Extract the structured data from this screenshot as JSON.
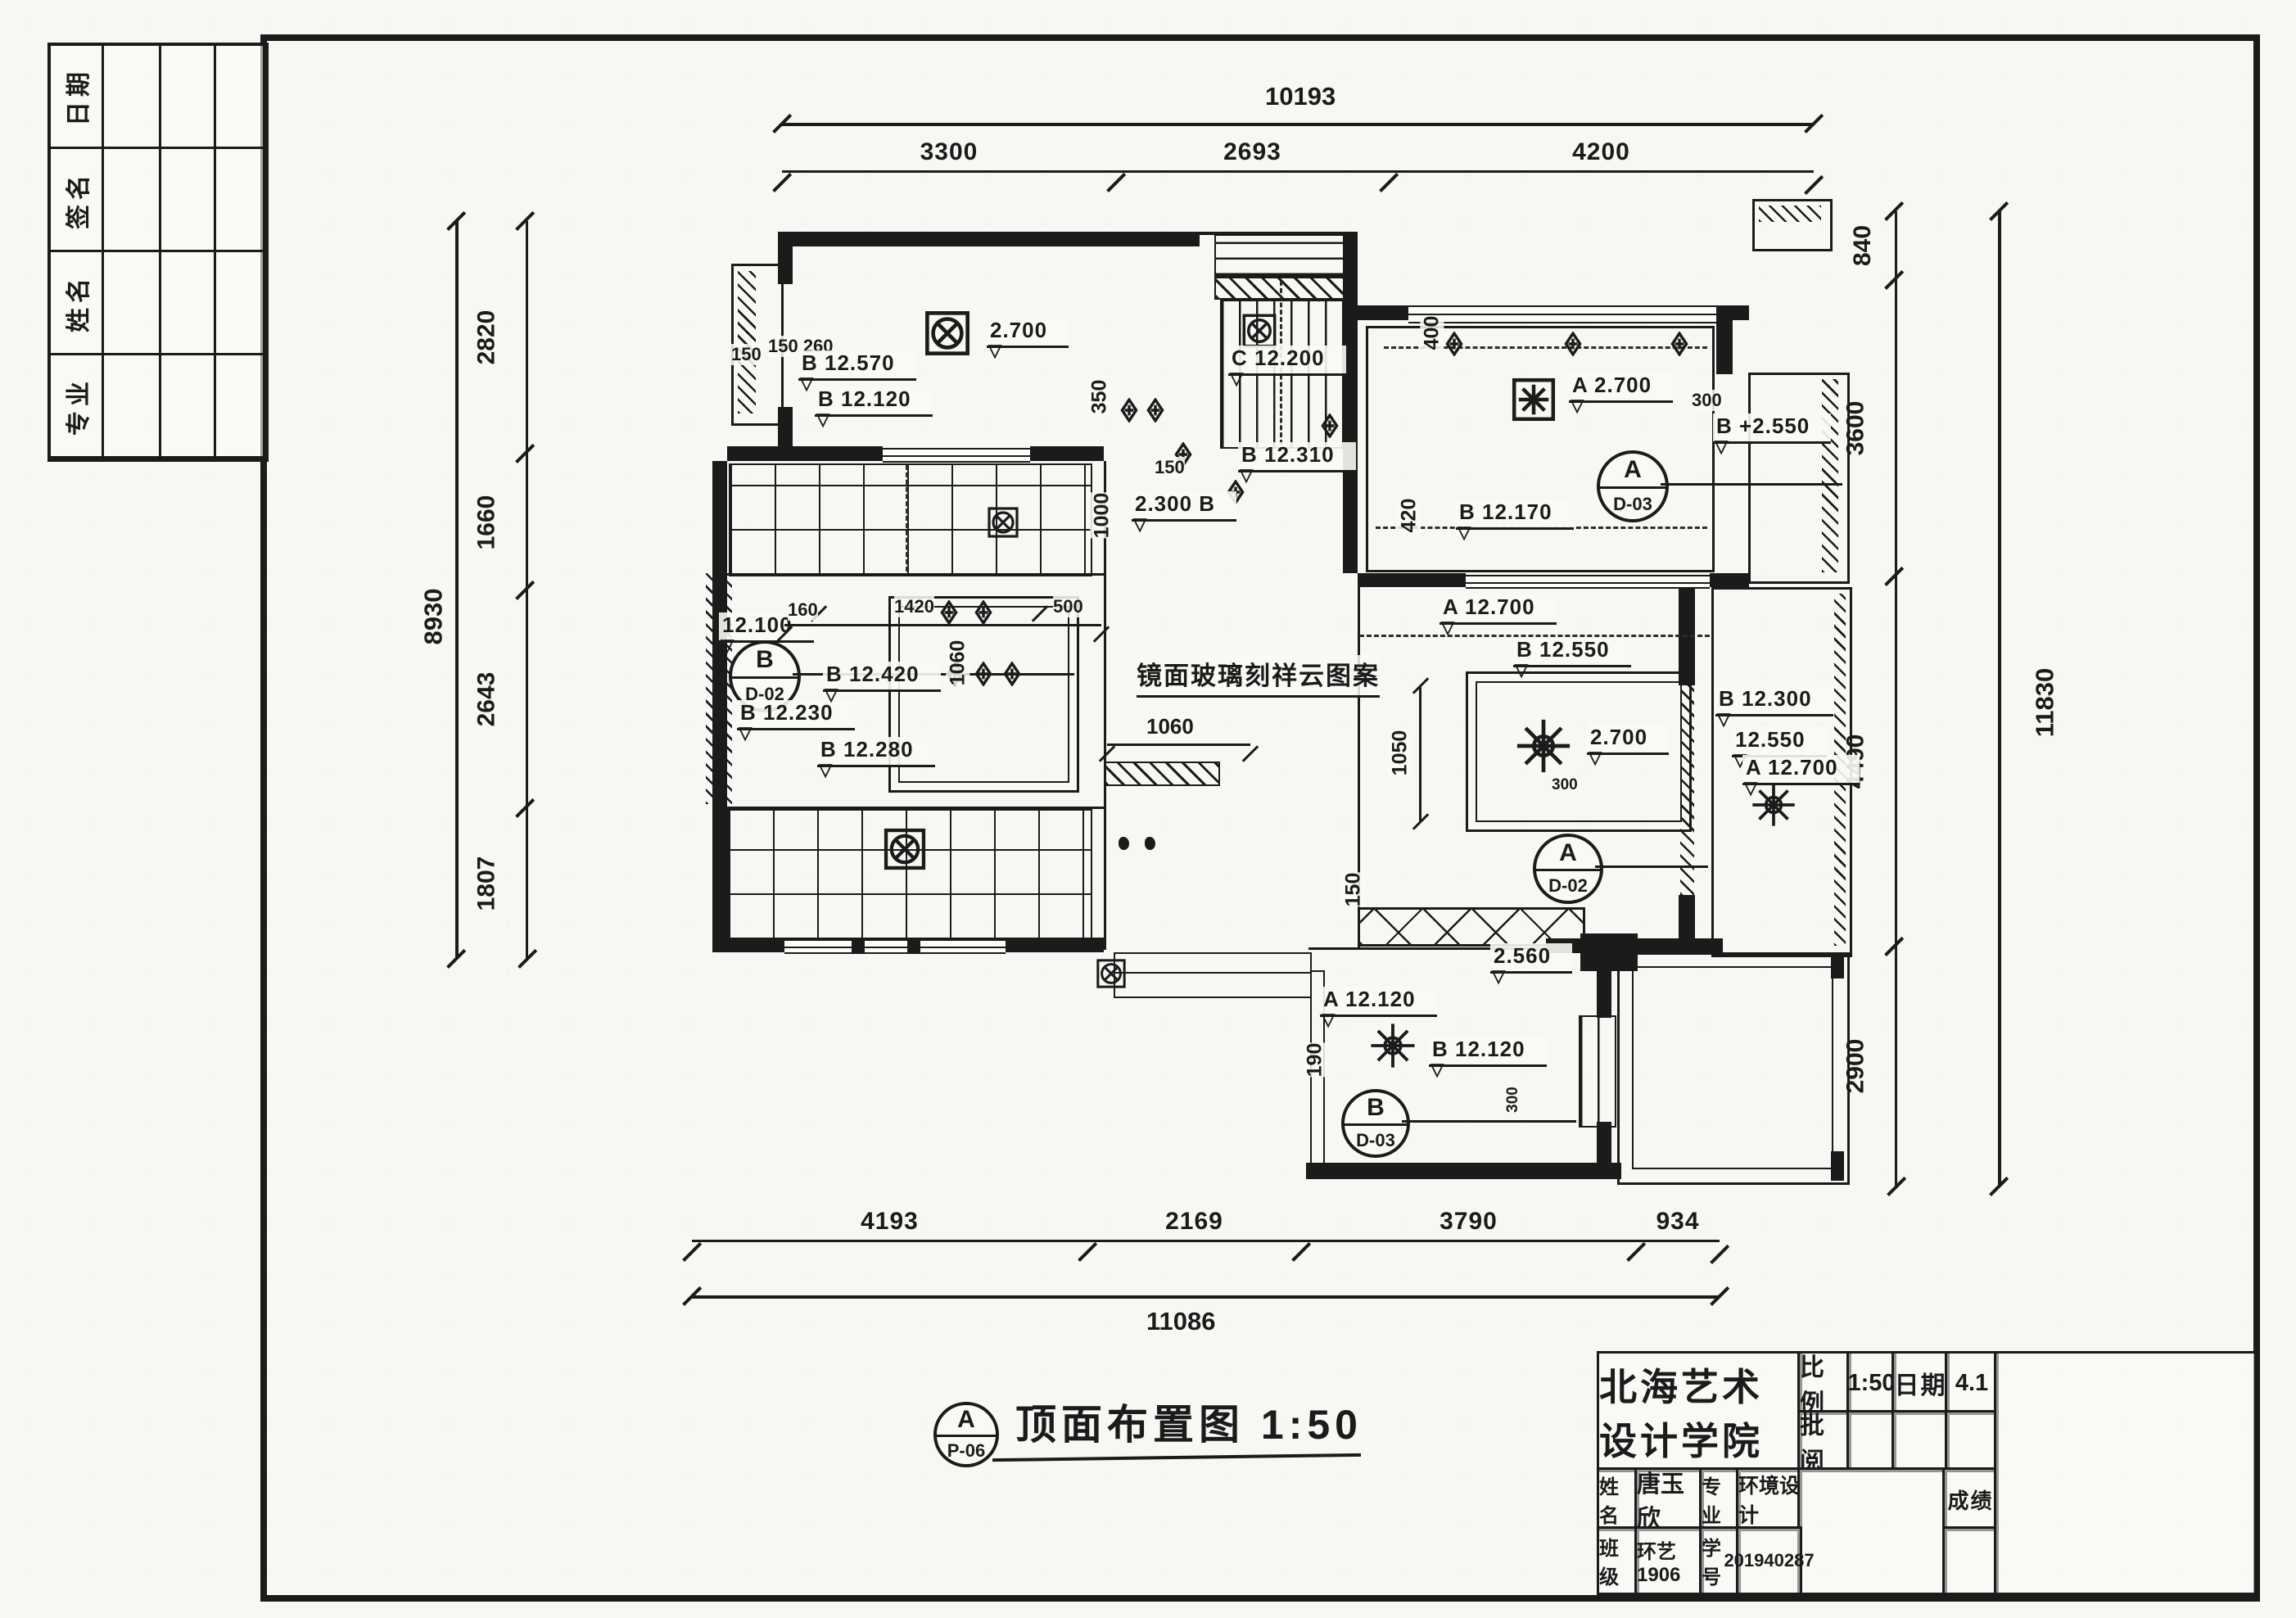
{
  "caption": {
    "title": "顶面布置图 1:50",
    "bubble_top": "A",
    "bubble_bottom": "P-06"
  },
  "revision_table": {
    "rows": [
      "日期",
      "签名",
      "姓名",
      "专业"
    ]
  },
  "title_block": {
    "school": "北海艺术设计学院",
    "scale_label": "比例",
    "scale_value": "1:50",
    "date_label": "日期",
    "date_value": "4.1",
    "review_label": "批阅",
    "name_label": "姓名",
    "name_value": "唐玉欣",
    "major_label": "专业",
    "major_value": "环境设计",
    "class_label": "班级",
    "class_value": "环艺1906",
    "sid_label": "学号",
    "sid_value": "201940287",
    "grade_label": "成绩"
  },
  "dims": {
    "top": {
      "overall": "10193",
      "segments": [
        "3300",
        "2693",
        "4200"
      ]
    },
    "left": {
      "overall": "8930",
      "segments": [
        "2820",
        "1660",
        "2643",
        "1807"
      ]
    },
    "right": {
      "overall": "11830",
      "segments": [
        "840",
        "3600",
        "4490",
        "2900"
      ]
    },
    "bottom": {
      "overall": "11086",
      "segments": [
        "4193",
        "2169",
        "3790",
        "934"
      ]
    }
  },
  "ann": {
    "room1_level_2700": "2.700",
    "room1_dim_150": "150",
    "room1_dim_150_260": "150 260",
    "room1_level_b12570": "B 12.570",
    "room1_level_b12120": "B 12.120",
    "hall_dim_350": "350",
    "hall_dim_150": "150",
    "hall_dim_1000": "1000",
    "hall_level_2300b": "2.300 B",
    "stair_level_c12200": "C 12.200",
    "hall_level_b12310": "B 12.310",
    "r2_dim_400": "400",
    "r2_level_a2700": "A 2.700",
    "r2_dim_300": "300",
    "r2_level_b2550": "B +2.550",
    "r2_dim_420": "420",
    "r2_level_b12170": "B 12.170",
    "r2_level_a12700": "A 12.700",
    "lr_level_b12550": "B 12.550",
    "lr_dim_1050": "1050",
    "lr_level_2700": "2.700",
    "lr_dim_150": "150",
    "lr_dim_300": "300",
    "bal_level_b12300": "B 12.300",
    "bal_level_12550": "12.550",
    "bal_level_a12700": "A 12.700",
    "ml_level_12100": "12.100",
    "ml_level_b12230": "B 12.230",
    "ml_level_b12280": "B 12.280",
    "ml_level_b12420": "B 12.420",
    "ml_dim_160": "160",
    "ml_dim_1420": "1420",
    "ml_dim_500": "500",
    "ml_dim_1060v": "1060",
    "ml_dim_1060h": "1060",
    "ml_note_mirror": "镜面玻璃刻祥云图案",
    "bb_level_2560": "2.560",
    "bb_level_a12120": "A 12.120",
    "bb_dim_190": "190",
    "bb_level_b12120": "B 12.120",
    "bb_dim_300": "300"
  },
  "bubbles": {
    "midleft": {
      "top": "B",
      "bottom": "D-02"
    },
    "topright": {
      "top": "A",
      "bottom": "D-03"
    },
    "living": {
      "top": "A",
      "bottom": "D-02"
    },
    "bedroom": {
      "top": "B",
      "bottom": "D-03"
    }
  }
}
